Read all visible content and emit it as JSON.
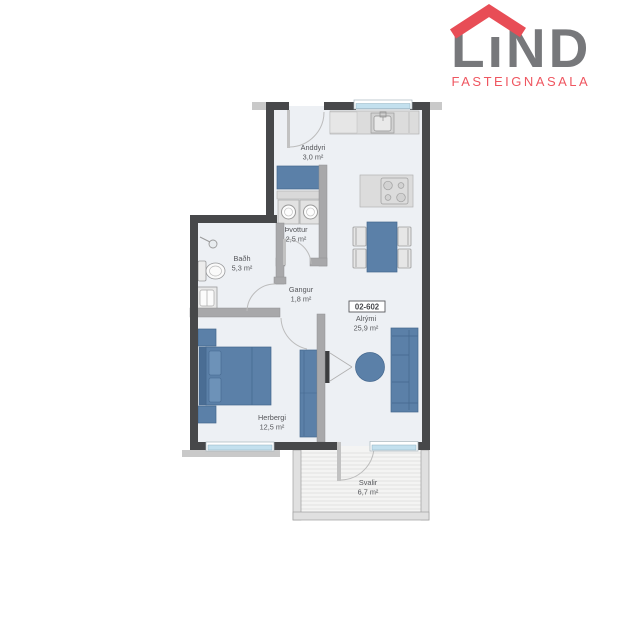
{
  "logo": {
    "brand": "LIND",
    "subtitle": "FASTEIGNASALA",
    "colors": {
      "roof_red": "#e84d56",
      "brand_gray": "#77787b",
      "subtitle_red": "#ef5660"
    }
  },
  "floorplan": {
    "unit_number": "02-602",
    "rooms": [
      {
        "name": "Anddyri",
        "area": "3,0 m²"
      },
      {
        "name": "Þvottur",
        "area": "2,5 m²"
      },
      {
        "name": "Baðh",
        "area": "5,3 m²"
      },
      {
        "name": "Gangur",
        "area": "1,8 m²"
      },
      {
        "name": "Alrými",
        "area": "25,9 m²"
      },
      {
        "name": "Herbergi",
        "area": "12,5 m²"
      },
      {
        "name": "Svalir",
        "area": "6,7 m²"
      }
    ],
    "colors": {
      "wall_dark": "#47484a",
      "wall_interior": "#a8a8aa",
      "floor": "#edf0f4",
      "furniture_blue": "#5b80a8",
      "window_blue": "#c3e0ee"
    }
  }
}
